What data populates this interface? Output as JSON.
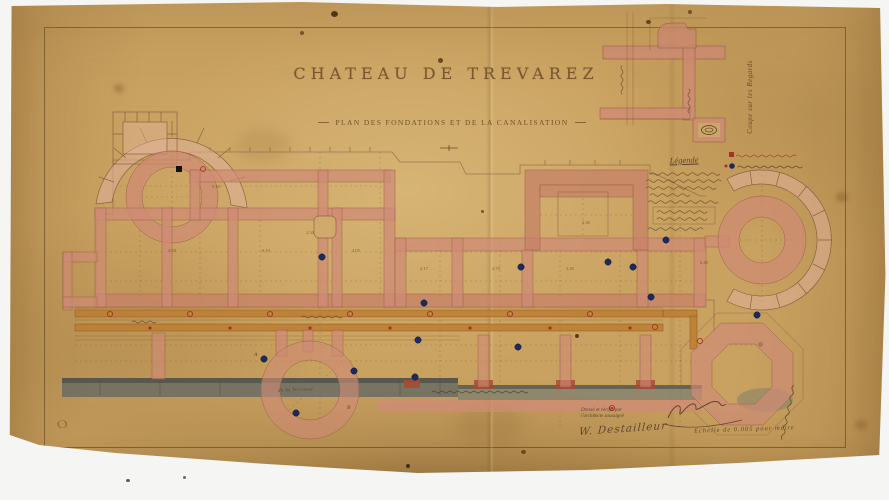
{
  "photo": {
    "backdrop_color": "#f5f5f3",
    "paper_color": "#c9a160"
  },
  "document": {
    "title": "CHATEAU DE TREVAREZ",
    "subtitle": "PLAN DES FONDATIONS ET DE LA CANALISATION"
  },
  "inset": {
    "caption": "Coupe sur les Regards"
  },
  "legend": {
    "heading": "Légende",
    "red_marker_color": "#a33325",
    "blue_marker_color": "#1d2a5c"
  },
  "plan": {
    "colors": {
      "wall": "#cf8b76",
      "canal": "#bd7c33",
      "terrace": "#6f6f63"
    },
    "terrace_label": "de la Terrasse",
    "point_labels": [
      "A",
      "B"
    ],
    "dimensions": [
      "4.50",
      "6.10",
      "4.05",
      "2.17",
      "4.70",
      "3.45",
      "5.20",
      "2.30",
      "6.40",
      "2.50"
    ]
  },
  "annotations": {
    "drafted_line1": "Dressé et vérifié par",
    "drafted_line2": "l'architecte soussigné",
    "architect_signature": "W. Destailleur",
    "scale_note": "Echelle de 0.005 pour mètre",
    "stamp": "O"
  }
}
